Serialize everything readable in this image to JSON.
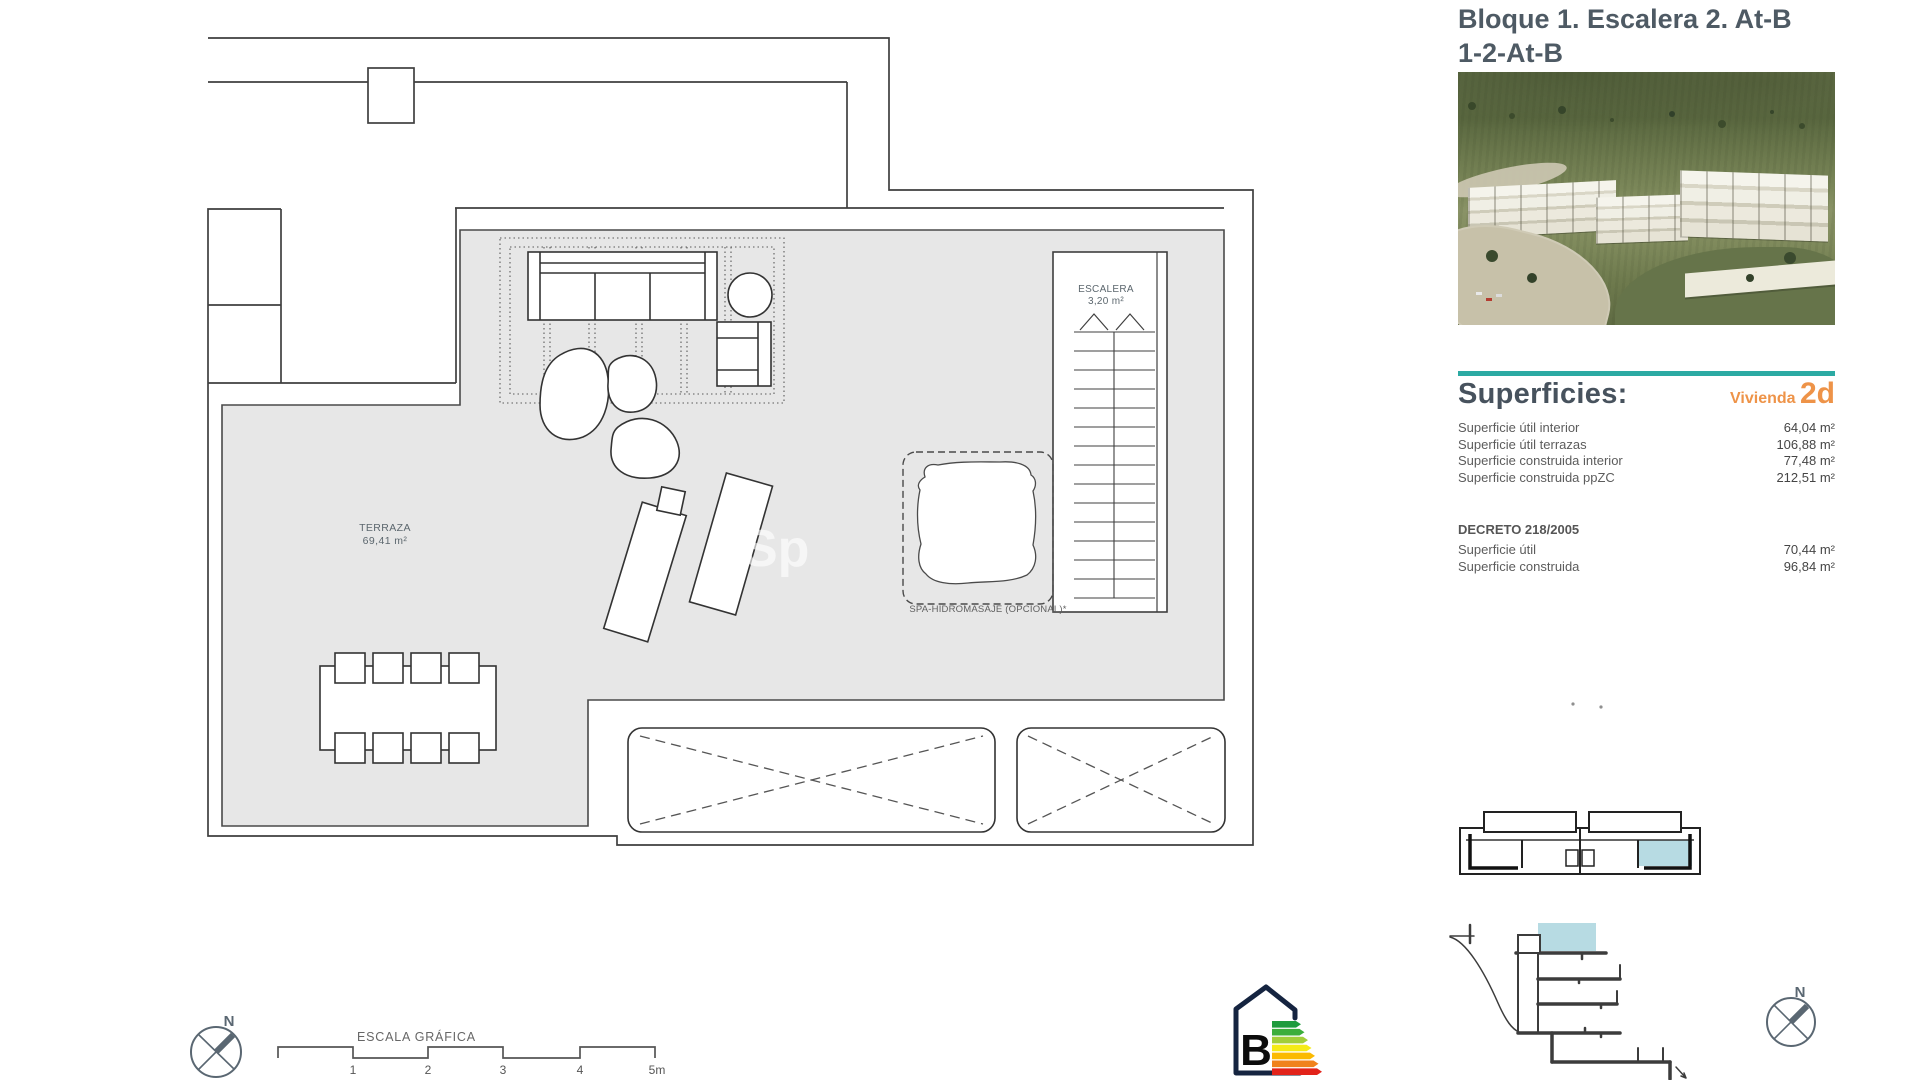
{
  "header": {
    "title_line1": "Bloque 1. Escalera 2. At-B",
    "title_line2": "1-2-At-B"
  },
  "superficies": {
    "heading": "Superficies:",
    "unit_label": "Vivienda",
    "unit_code": "2d",
    "rows": [
      {
        "label": "Superficie útil interior",
        "value": "64,04 m²"
      },
      {
        "label": "Superficie útil terrazas",
        "value": "106,88 m²"
      },
      {
        "label": "Superficie construida interior",
        "value": "77,48 m²"
      },
      {
        "label": "Superficie construida ppZC",
        "value": "212,51 m²"
      }
    ],
    "decreto_heading": "DECRETO 218/2005",
    "decreto_rows": [
      {
        "label": "Superficie útil",
        "value": "70,44 m²"
      },
      {
        "label": "Superficie construida",
        "value": "96,84 m²"
      }
    ]
  },
  "plan": {
    "terraza_label": "TERRAZA",
    "terraza_area": "69,41 m²",
    "escalera_label": "ESCALERA",
    "escalera_area": "3,20 m²",
    "spa_label": "SPA-HIDROMASAJE (OPCIONAL)*",
    "watermark": "Sp"
  },
  "scale_bar": {
    "title": "ESCALA GRÁFICA",
    "ticks": [
      "1",
      "2",
      "3",
      "4",
      "5m"
    ]
  },
  "north": {
    "label": "N"
  },
  "energy": {
    "rating": "B",
    "bar_colors": [
      "#1e9b3d",
      "#3cae3b",
      "#a2ce39",
      "#f5eb16",
      "#fbba02",
      "#f0821c",
      "#e2231a"
    ]
  },
  "colors": {
    "teal_accent": "#2caaa3",
    "orange_accent": "#ee9348",
    "terrace_gray": "#e7e7e7",
    "highlight_blue": "#b7dbe3",
    "title_gray": "#4e5a64"
  }
}
